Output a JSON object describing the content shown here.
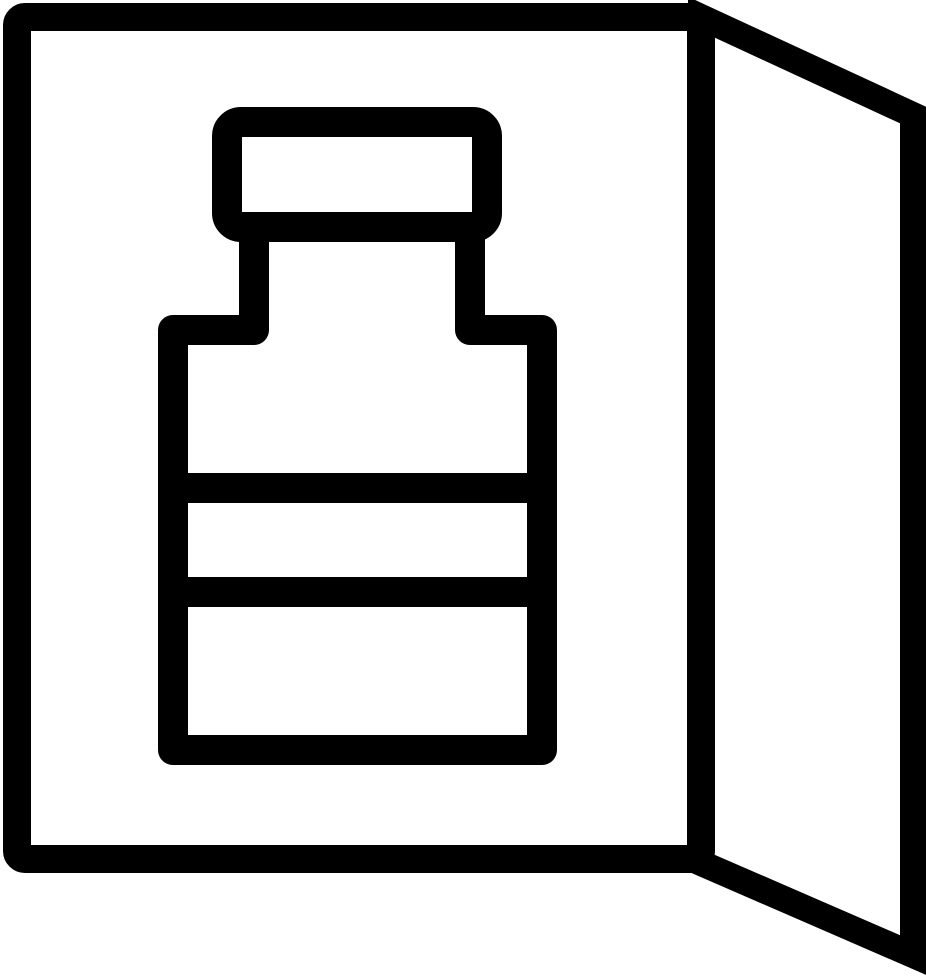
{
  "icon": {
    "name": "open-medicine-box-with-bottle",
    "parts": {
      "door": "door-open-right",
      "box": "box-front-panel",
      "cap": "bottle-cap",
      "body": "bottle-body",
      "band_top": "bottle-label-band-top",
      "band_bottom": "bottle-label-band-bottom"
    },
    "colors": {
      "foreground": "#000000",
      "background": "#ffffff"
    }
  }
}
